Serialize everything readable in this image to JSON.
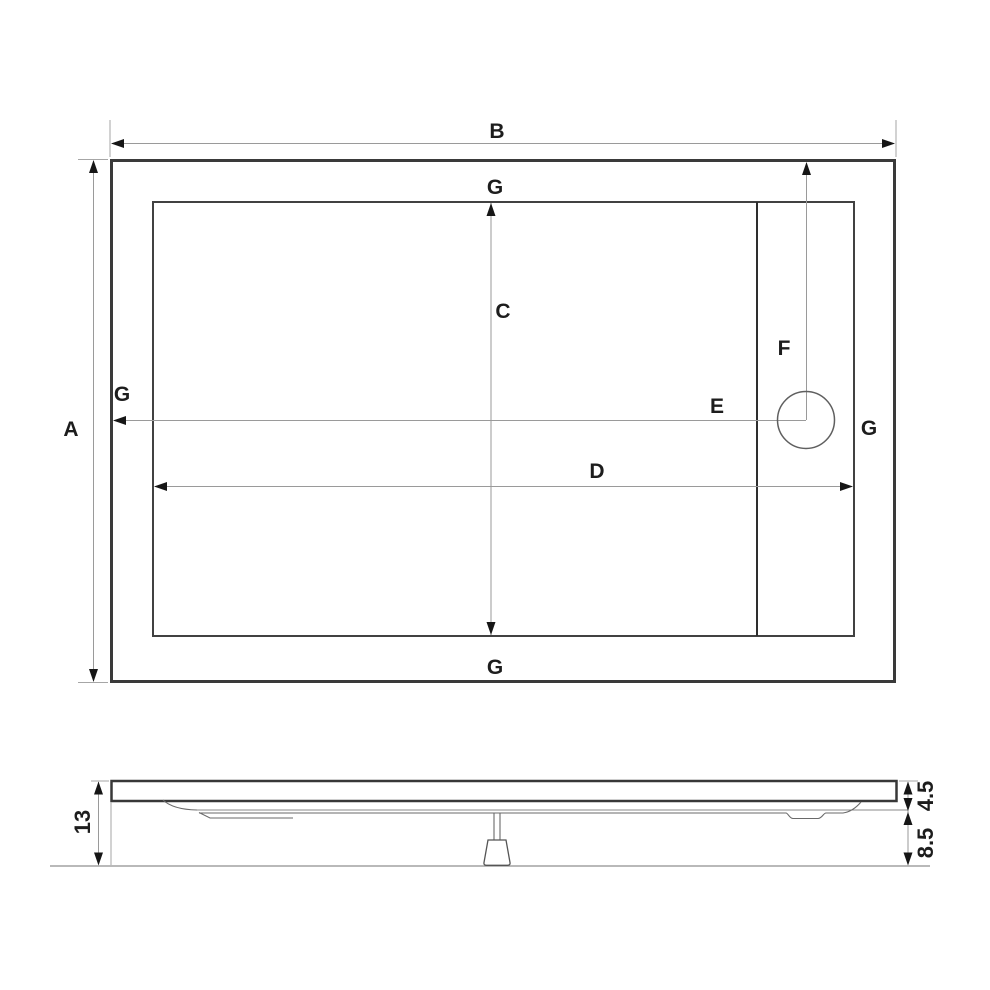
{
  "top_view": {
    "dim_overall_height": "A",
    "dim_overall_width": "B",
    "dim_inner_height": "C",
    "dim_inner_width": "D",
    "dim_drain_from_left": "E",
    "dim_drain_from_top": "F",
    "rim_top": "G",
    "rim_left": "G",
    "rim_right": "G",
    "rim_bottom": "G"
  },
  "side_view": {
    "total_height": "13",
    "rim_height": "4.5",
    "base_height": "8.5"
  },
  "colors": {
    "background": "#ffffff",
    "line_strong": "#3a3a3a",
    "line_dimension": "#9a9a9a",
    "arrow": "#161616",
    "text": "#1d1d1d"
  }
}
